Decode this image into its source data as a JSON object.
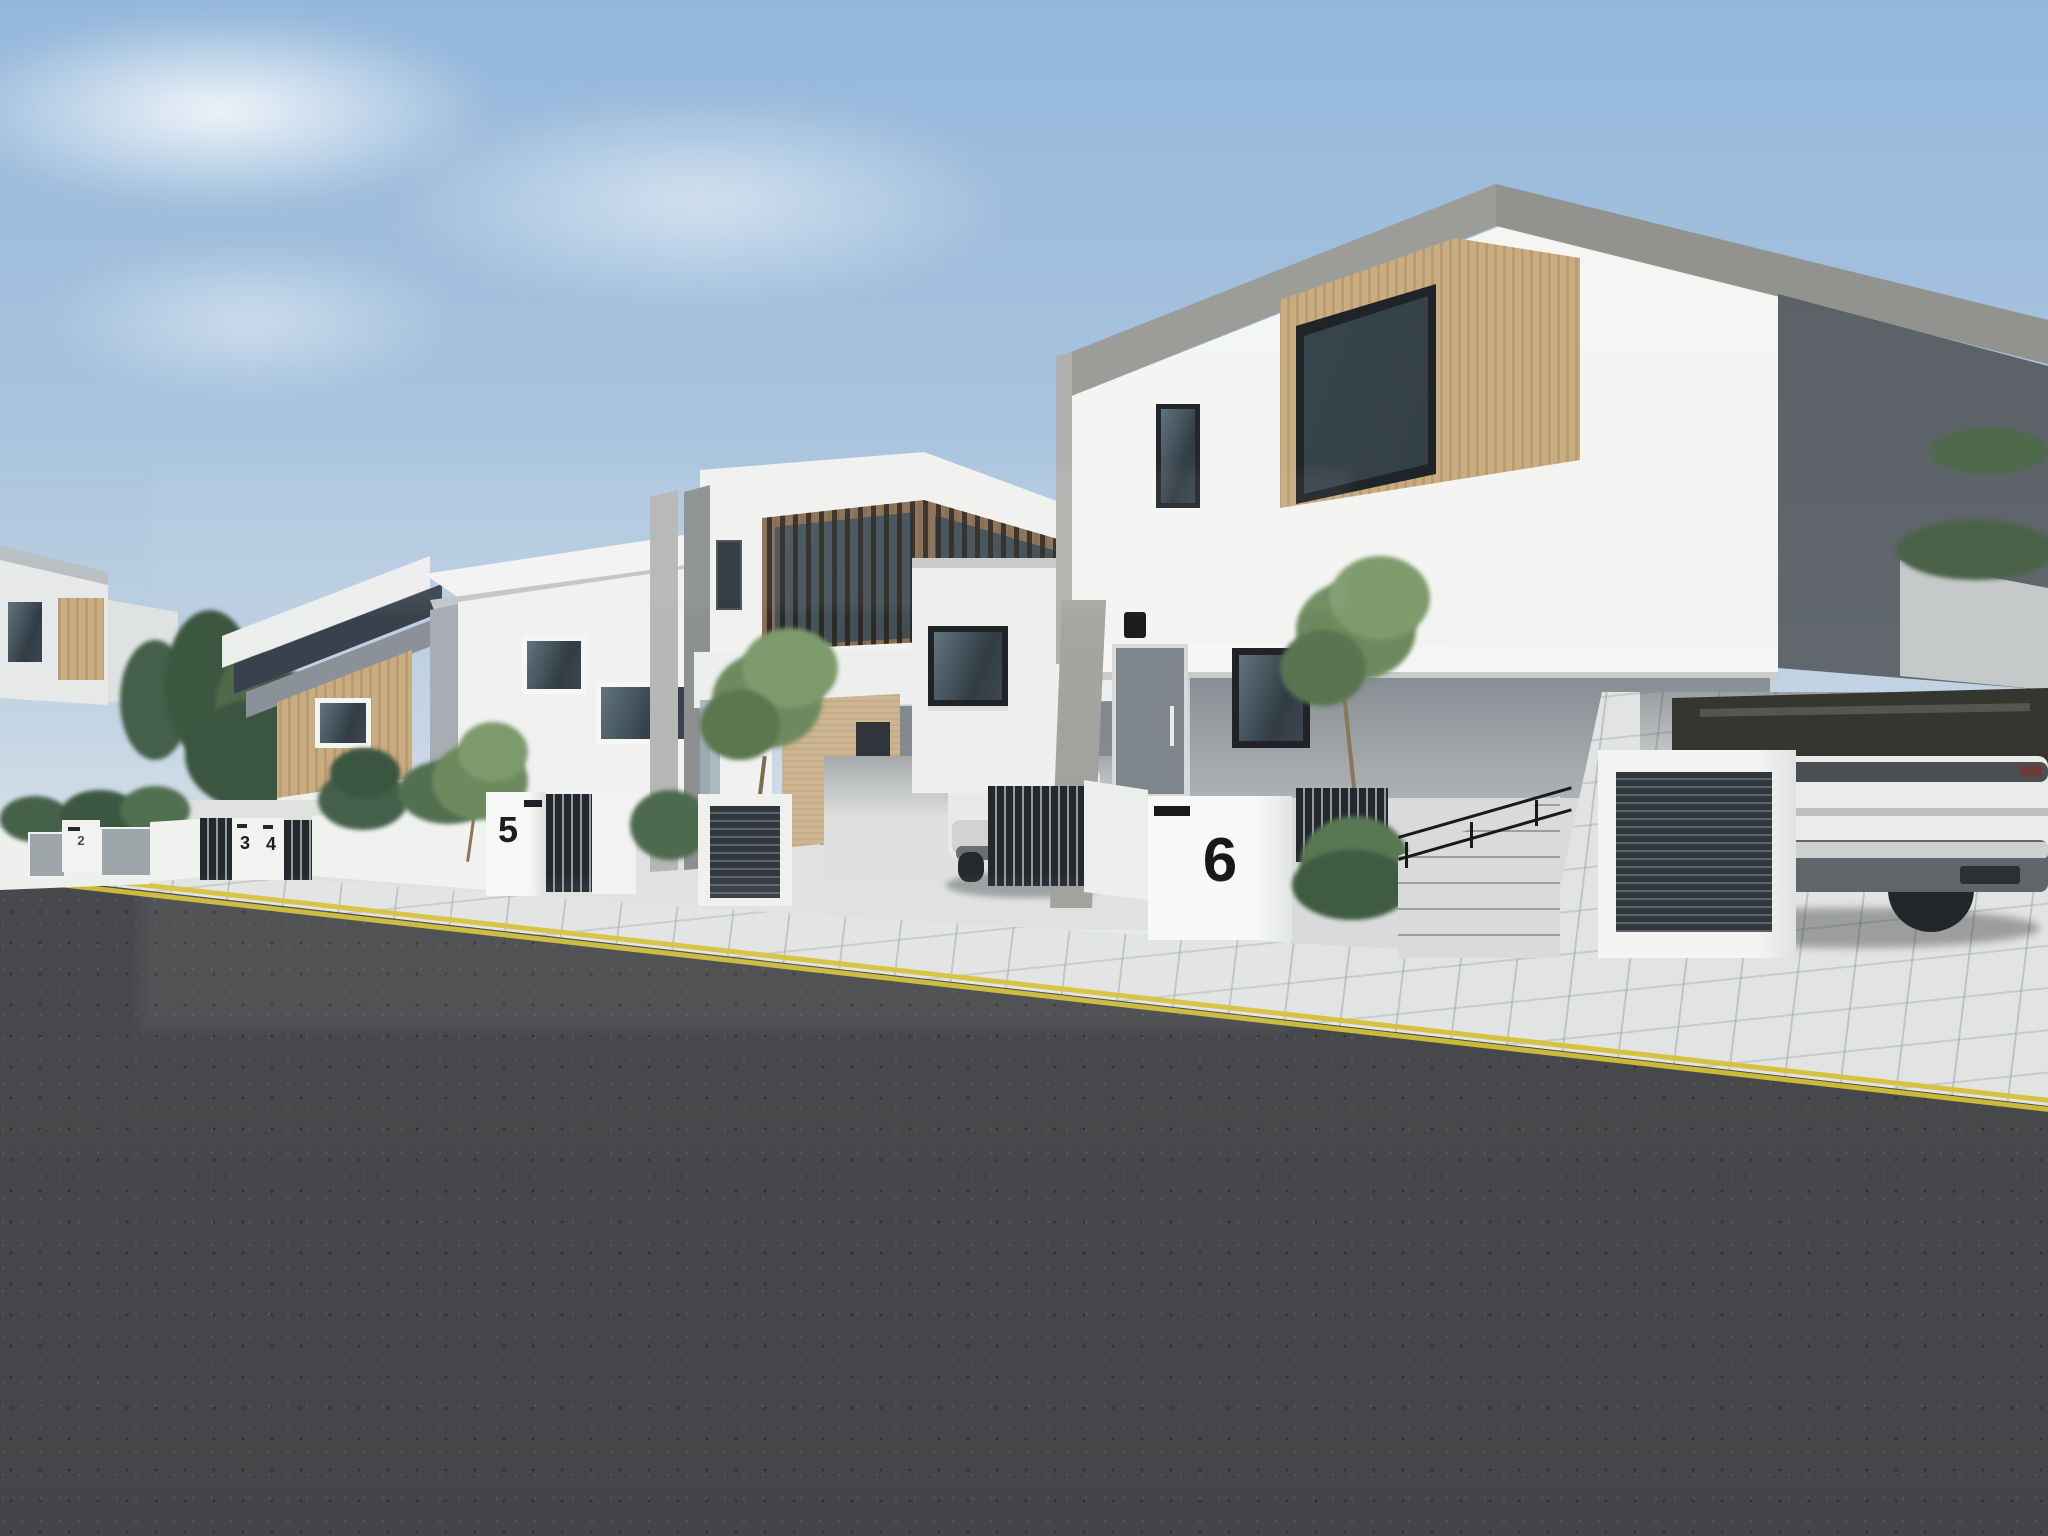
{
  "house_numbers": [
    {
      "position": "far-left-pillar",
      "label": "2"
    },
    {
      "position": "left-pillar-a",
      "label": "3"
    },
    {
      "position": "left-pillar-b",
      "label": "4"
    },
    {
      "position": "center-pillar",
      "label": "5"
    },
    {
      "position": "right-pillar",
      "label": "6"
    }
  ],
  "road_markings": {
    "type": "double-yellow-line",
    "color": "#d6c23e"
  },
  "vehicles": [
    {
      "kind": "white-suv-rear-under-carport"
    },
    {
      "kind": "white-sedan-rear-in-driveway"
    }
  ],
  "colors": {
    "sky_top": "#96b9dc",
    "sky_horizon": "#e9edef",
    "wall_white": "#f2f3f1",
    "concrete_grey": "#9b9b98",
    "wood_cladding": "#c9ac80",
    "dark_slats": "#23282d",
    "window_glass": "#313c44",
    "foliage_green": "#5d7a4e",
    "pavement": "#e2e4e3",
    "asphalt": "#4a4b4e",
    "yellow_line": "#d6c23e",
    "vehicle_white": "#ebecea"
  }
}
